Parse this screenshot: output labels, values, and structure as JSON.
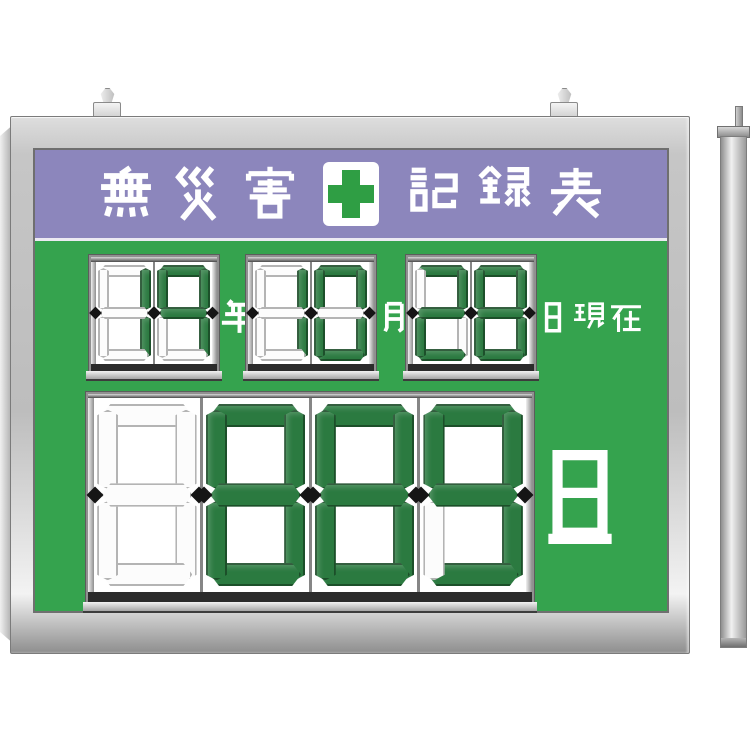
{
  "product": {
    "name": "無災害記録表"
  },
  "colors": {
    "header_purple": "#8c86bc",
    "board_green": "#35a34e",
    "cross_green": "#2f9e44",
    "segment_on_green": "#2b7a40",
    "frame_silver": "#c9c9c9"
  },
  "header": {
    "title_left": "無災害",
    "title_right": "記録表",
    "title_full": "無災害記録表",
    "cross_icon": "green-cross"
  },
  "date": {
    "groups": [
      {
        "name": "year",
        "value": "19",
        "digits": [
          "bc",
          "abcfg"
        ],
        "label": "年"
      },
      {
        "name": "month",
        "value": "10",
        "digits": [
          "bc",
          "abcdef"
        ],
        "label": "月"
      },
      {
        "name": "day",
        "value": "28",
        "digits": [
          "abdeg",
          "abcdefg"
        ],
        "label": "日現在"
      }
    ]
  },
  "counter": {
    "name": "consecutive-safe-days",
    "value": "889",
    "leading_blank": true,
    "digits": [
      "",
      "abcdefg",
      "abcdefg",
      "abcdfg"
    ],
    "unit_label": "日"
  }
}
